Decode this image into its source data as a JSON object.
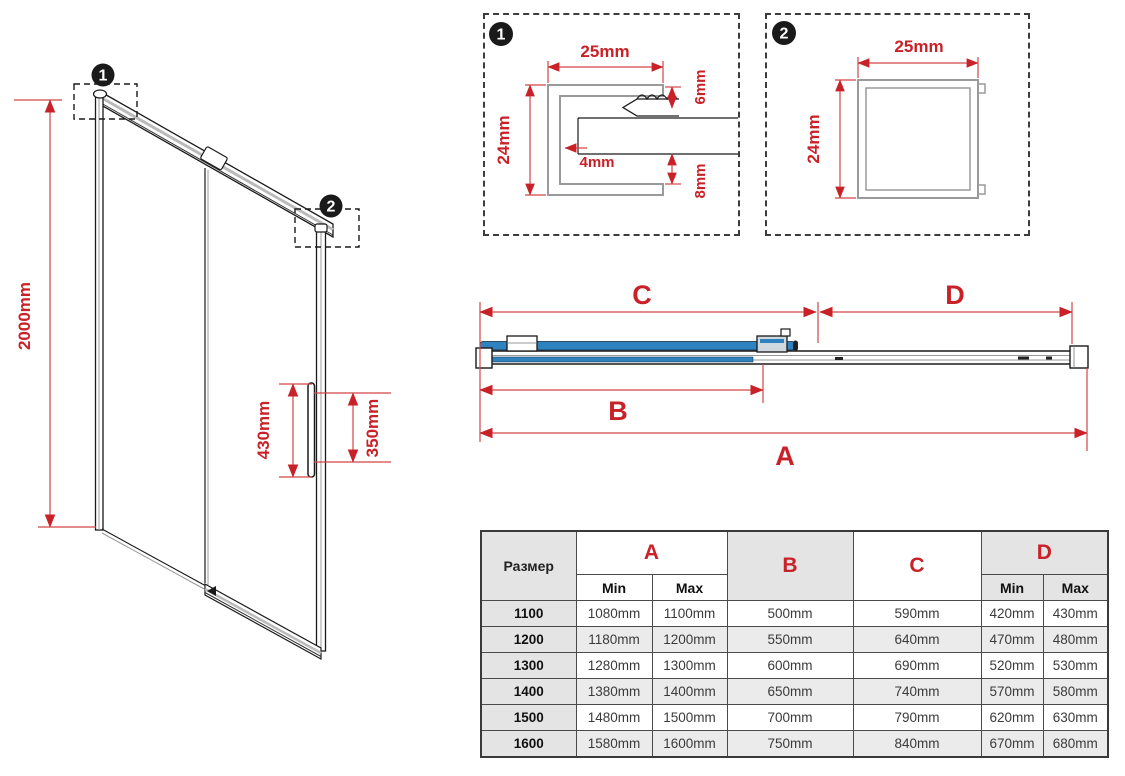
{
  "colors": {
    "accent_red": "#c92128",
    "dim_line_red": "#d24545",
    "glass_blue": "#2e82c0",
    "drawing_black": "#1a1a1a",
    "table_gray": "#e4e4e4"
  },
  "door_view": {
    "height_dim": "2000mm",
    "handle_height_dim": "430mm",
    "handle_spacing_dim": "350mm",
    "callout_1": "1",
    "callout_2": "2"
  },
  "detail_1": {
    "badge": "1",
    "width_dim": "25mm",
    "height_dim": "24mm",
    "top_dim": "6mm",
    "gap_dim": "4mm",
    "bottom_dim": "8mm"
  },
  "detail_2": {
    "badge": "2",
    "width_dim": "25mm",
    "height_dim": "24mm"
  },
  "plan_view": {
    "dim_a": "A",
    "dim_b": "B",
    "dim_c": "C",
    "dim_d": "D"
  },
  "table": {
    "size_header": "Размер",
    "col_a": "A",
    "col_b": "B",
    "col_c": "C",
    "col_d": "D",
    "min_label": "Min",
    "max_label": "Max",
    "rows": [
      {
        "size": "1100",
        "a_min": "1080mm",
        "a_max": "1100mm",
        "b": "500mm",
        "c": "590mm",
        "d_min": "420mm",
        "d_max": "430mm"
      },
      {
        "size": "1200",
        "a_min": "1180mm",
        "a_max": "1200mm",
        "b": "550mm",
        "c": "640mm",
        "d_min": "470mm",
        "d_max": "480mm"
      },
      {
        "size": "1300",
        "a_min": "1280mm",
        "a_max": "1300mm",
        "b": "600mm",
        "c": "690mm",
        "d_min": "520mm",
        "d_max": "530mm"
      },
      {
        "size": "1400",
        "a_min": "1380mm",
        "a_max": "1400mm",
        "b": "650mm",
        "c": "740mm",
        "d_min": "570mm",
        "d_max": "580mm"
      },
      {
        "size": "1500",
        "a_min": "1480mm",
        "a_max": "1500mm",
        "b": "700mm",
        "c": "790mm",
        "d_min": "620mm",
        "d_max": "630mm"
      },
      {
        "size": "1600",
        "a_min": "1580mm",
        "a_max": "1600mm",
        "b": "750mm",
        "c": "840mm",
        "d_min": "670mm",
        "d_max": "680mm"
      }
    ]
  }
}
